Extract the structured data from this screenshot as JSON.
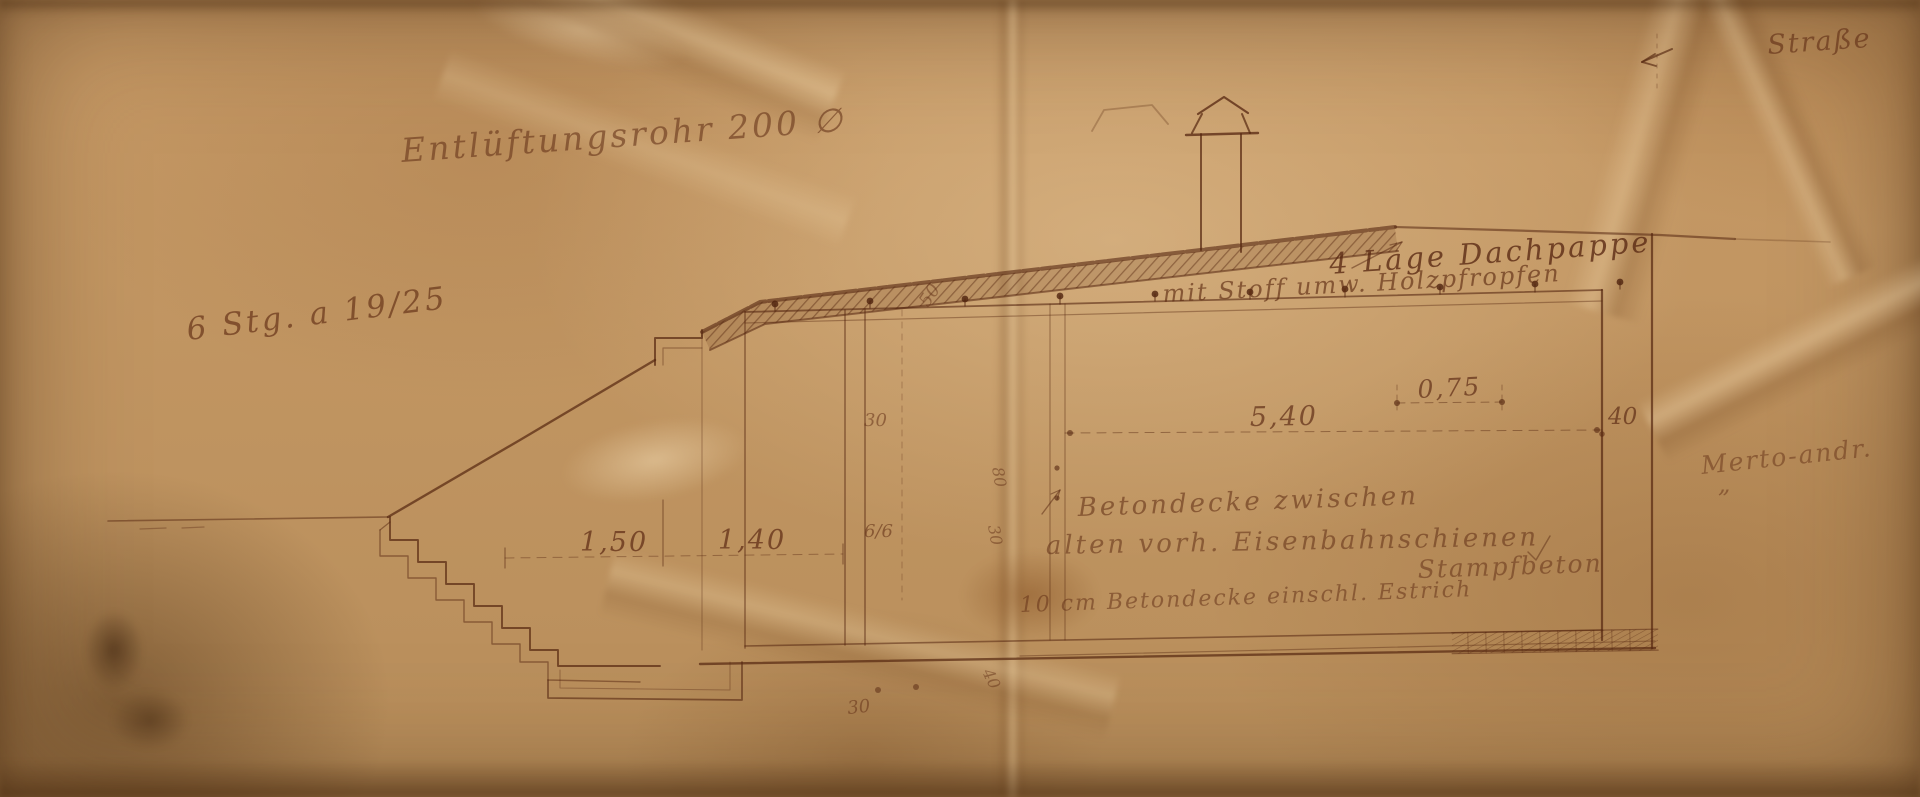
{
  "colors": {
    "paper": "#c2955f",
    "ink": "#552610",
    "ink_faint": "#7a4526"
  },
  "annotations": {
    "vent_pipe": "Entlüftungsrohr 200 ∅",
    "street": "Straße",
    "stair_note": "6 Stg. a 19/25",
    "roofing_line1": "4 Lage Dachpappe",
    "roofing_line2": "mit Stoff umw. Holzpfropfen",
    "ceiling_line1": "Betondecke zwischen",
    "ceiling_line2": "alten vorh. Eisenbahnschienen",
    "ceiling_line3": "Stampfbeton",
    "floor_note": "10 cm Betondecke einschl. Estrich",
    "margin_note": "Merto-andr.",
    "margin_ditto": "„"
  },
  "dimensions": {
    "stair_run": "1,50",
    "stair_landing": "1,40",
    "room_width": "5,40",
    "roof_recess": "0,75",
    "right_wall": "40",
    "partition": "30",
    "beam_section": "6/6",
    "roof_slab": "50",
    "rail_depth": "80",
    "rail_width": "30",
    "footing_left": "30",
    "floor_edge": "40"
  }
}
